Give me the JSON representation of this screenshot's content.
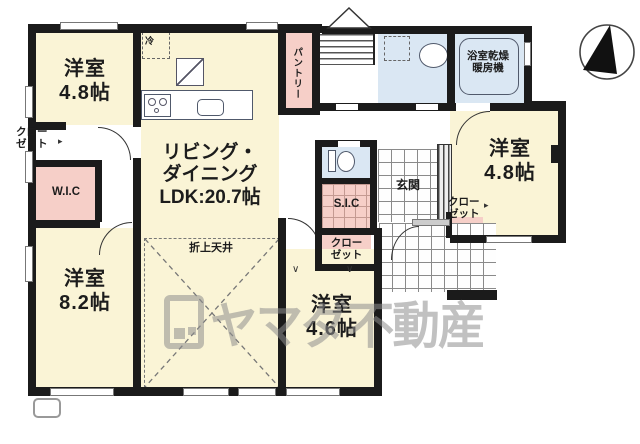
{
  "labels": {
    "room_tl": [
      "洋室",
      "4.8帖"
    ],
    "room_bl": [
      "洋室",
      "8.2帖"
    ],
    "room_tr": [
      "洋室",
      "4.8帖"
    ],
    "room_bm": [
      "洋室",
      "4.6帖"
    ],
    "ldk": [
      "リビング・",
      "ダイニング",
      "LDK:20.7帖"
    ],
    "coffered_ceiling": "折上天井",
    "wic": "W.I.C",
    "sic": "S.I.C",
    "pantry": "パントリー",
    "genkan": "玄関",
    "bath_heater": [
      "浴室乾燥",
      "暖房機"
    ],
    "fridge": "冷",
    "closet": [
      "クロー",
      "ゼット"
    ],
    "hanger_mark": "∨"
  },
  "watermark": {
    "text": "ヤマダ不動産"
  },
  "icons": [
    "north-arrow-icon",
    "stairs-up-chevron-icon",
    "watermark-logo-icon",
    "closet-pointer-icon"
  ],
  "colors": {
    "room_yellow": "#faf4d6",
    "closet_pink": "#f6cfc8",
    "wet_area_blue": "#dae7f3",
    "wall_black": "#1b1b1b",
    "watermark_gray": "#8f8f8f"
  }
}
